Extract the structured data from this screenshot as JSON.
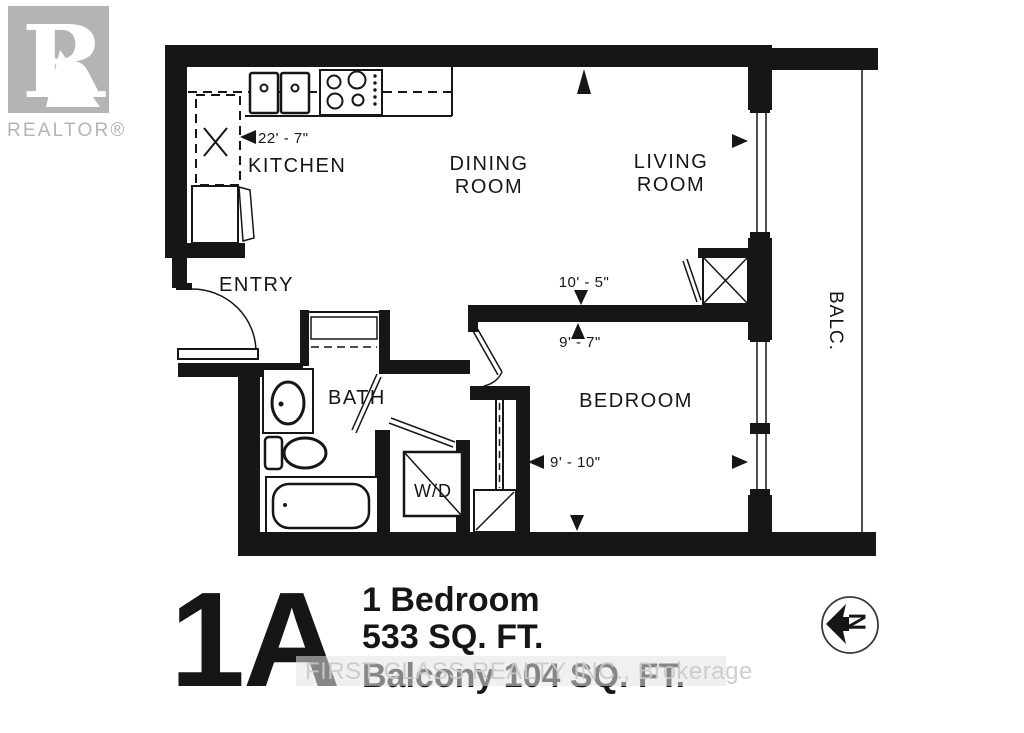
{
  "logo": {
    "brand": "REALTOR®",
    "icon": "realtor-block-r-icon",
    "color": "#b4b4b4"
  },
  "plan": {
    "ink_color": "#161616",
    "rooms": {
      "kitchen": "KITCHEN",
      "dining_line1": "DINING",
      "dining_line2": "ROOM",
      "living_line1": "LIVING",
      "living_line2": "ROOM",
      "entry": "ENTRY",
      "bath": "BATH",
      "bedroom": "BEDROOM",
      "balcony": "BALC.",
      "washer_dryer": "W/D"
    },
    "dimensions": {
      "main_width": "22' - 7\"",
      "dining_depth": "10' - 5\"",
      "bedroom_depth": "9' - 7\"",
      "bedroom_width": "9' - 10\""
    },
    "fixture_icons": [
      "double-sink-icon",
      "stove-icon",
      "fridge-icon",
      "pantry-x-icon",
      "entry-door-icon",
      "bath-vanity-icon",
      "toilet-icon",
      "bathtub-icon",
      "washer-dryer-icon",
      "sliding-closet-icon",
      "hvac-closet-icon",
      "window-icon",
      "balcony-railing-icon"
    ]
  },
  "footer": {
    "unit_code": "1A",
    "line1": "1 Bedroom",
    "line2": "533 SQ. FT.",
    "line3": "Balcony 104 SQ. FT."
  },
  "watermark": {
    "text": "FIRST CLASS REALTY INC., Brokerage",
    "color": "#c9c9c9"
  },
  "compass": {
    "label": "N",
    "icon": "north-arrow-icon"
  }
}
